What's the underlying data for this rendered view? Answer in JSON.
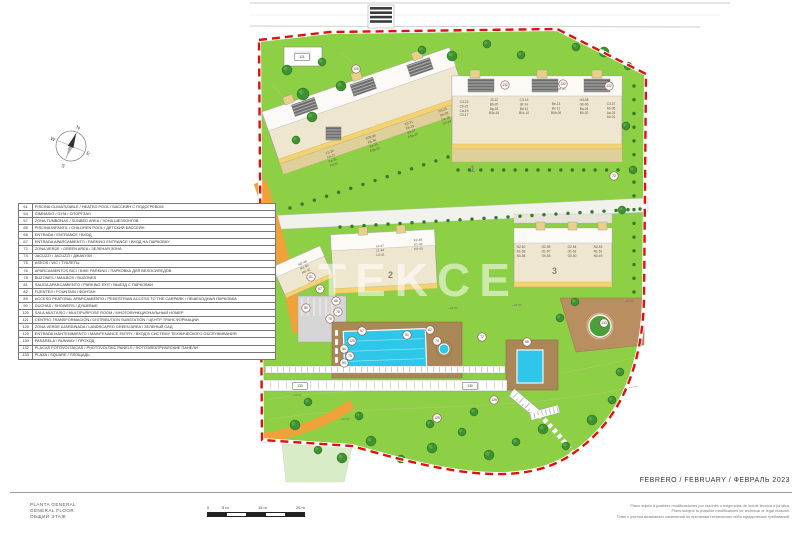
{
  "sheet": {
    "title_block": [
      "PLANTA GENERAL",
      "GENERAL FLOOR",
      "ОБЩИЙ ЭТАЖ"
    ],
    "date": "FEBRERO / FEBRUARY / ФЕВРАЛЬ 2023",
    "disclaimer": [
      "Plano sujeto a posibles modificaciones por razones o exigencias de índole técnica o jurídica.",
      "Plans subject to possible modifications for technical or legal reasons.",
      "План с учетом возможных изменений по причинам технических либо юридических требований."
    ],
    "scale": {
      "labels": [
        "0",
        "5 m",
        "15 m",
        "25 m"
      ]
    },
    "compass": {
      "n": "N",
      "e": "E",
      "s": "S",
      "w": "W"
    }
  },
  "legend": {
    "rows": [
      {
        "num": "51",
        "label": "PISCINA CLIMATIZABLE / HEATED POOL / БАССЕЙН С ПОДОГРЕВОМ"
      },
      {
        "num": "54",
        "label": "GIMNASIO / GYM / СПОРТЗАЛ"
      },
      {
        "num": "57",
        "label": "ZONA TUMBONAS / SUNBED AREA / ЗОНА ШЕЗЛОНГОВ"
      },
      {
        "num": "65",
        "label": "PISCINA INFANTIL / CHILDREN POOL / ДЕТСКИЙ БАССЕЙН"
      },
      {
        "num": "66",
        "label": "ENTRADA / ENTRANCE / ВХОД"
      },
      {
        "num": "67",
        "label": "ENTRADA APARCAMIENTO / PARKING ENTRANCE / ВХОД НА ПАРКОВКУ"
      },
      {
        "num": "72",
        "label": "ZONA VERDE / GREEN AREA / ЗЕЛЕНАЯ ЗОНА"
      },
      {
        "num": "74",
        "label": "JACUZZI / JACUZZI / ДЖАКУЗИ"
      },
      {
        "num": "75",
        "label": "ASEOS / WC / ТУАЛЕТЫ"
      },
      {
        "num": "76",
        "label": "APARCAMIENTOS BICI / BIKE PARKING / ПАРКОВКА ДЛЯ ВЕЛОСИПЕДОВ"
      },
      {
        "num": "78",
        "label": "BUZONES / MAILBOX / BUZONES"
      },
      {
        "num": "81",
        "label": "SALIDA APARCAMIENTO / PARKING EXIT / ВЫЕЗД С ПАРКОВКИ"
      },
      {
        "num": "82",
        "label": "FUENTES / FOUNTAIN / ФОНТАН"
      },
      {
        "num": "89",
        "label": "ACCESO PEATONAL APARCAMIENTO / PEDESTRIAN ACCESS TO THE CARPARK / ПЕШЕХОДНАЯ ПАРКОВКА"
      },
      {
        "num": "90",
        "label": "DUCHAS / SHOWERS / ДУШЕВЫЕ"
      },
      {
        "num": "120",
        "label": "SALA MULTIUSO / MULTIPURPOSE ROOM / МНОГОФУНКЦИОНАЛЬНЫЙ НОМЕР"
      },
      {
        "num": "121",
        "label": "CENTRO TRANSFORMACIÓN / DISTRIBUTION SUBSTATION / ЦЕНТР ТРАНСФОРМАЦИИ"
      },
      {
        "num": "125",
        "label": "ZONA VERDE AJARDINADA / LANDSCAPED GREEN AREA / ЗЕЛЕНЫЙ САД"
      },
      {
        "num": "129",
        "label": "ENTRADA MANTENIMIENTO / MAINTENANCE ENTRY / ВХОД В СИСТЕМУ ТЕХНИЧЕСКОГО ОБСЛУЖИВАНИЯ"
      },
      {
        "num": "130",
        "label": "PASARELA / RUNWAY / ПРОХОД"
      },
      {
        "num": "132",
        "label": "PLACAS FOTOVOLTAICAS / PHOTOVOLTAIC PANELS / ФОТОЭЛЕКТРИЧЕСКИЕ ПАНЕЛИ"
      },
      {
        "num": "133",
        "label": "PLAZA / SQUARE / ПЛОЩАДЬ"
      }
    ]
  },
  "plan": {
    "watermark": "TEKCE",
    "colors": {
      "green": "#8dcf45",
      "light_green": "#d9ecc8",
      "boundary_red": "#dd1111",
      "pool_blue": "#2ec7e9",
      "deck_brown": "#aa8757",
      "building_cream": "#efe6cf",
      "road_orange": "#f0a23a",
      "accent_yellow": "#f2d271"
    },
    "building_numbers": [
      {
        "text": "1",
        "x": 470,
        "y": 172
      },
      {
        "text": "2",
        "x": 388,
        "y": 278
      },
      {
        "text": "3",
        "x": 552,
        "y": 274
      }
    ],
    "unit_groups": [
      {
        "x": 464,
        "y": 103,
        "rot": 0,
        "lines": [
          "C3-23",
          "Cb-21",
          "Ca-19",
          "C0-17"
        ]
      },
      {
        "x": 494,
        "y": 101,
        "rot": 0,
        "lines": [
          "J3-22",
          "Bb-20",
          "Bg-18",
          "B0a-16"
        ]
      },
      {
        "x": 524,
        "y": 101,
        "rot": 0,
        "lines": [
          "C3-15",
          "Bf-14",
          "Bd-12",
          "B0c-10"
        ]
      },
      {
        "x": 556,
        "y": 105,
        "rot": 0,
        "lines": [
          "Be-13",
          "Bc-11",
          "B0b-09"
        ]
      },
      {
        "x": 584,
        "y": 101,
        "rot": 0,
        "lines": [
          "H3-08",
          "Gb-06",
          "Ba-04",
          "B0-02"
        ]
      },
      {
        "x": 611,
        "y": 105,
        "rot": 0,
        "lines": [
          "C3-07",
          "Ab-05",
          "Aa-03",
          "A0-01"
        ]
      },
      {
        "x": 330,
        "y": 153,
        "rot": -19,
        "lines": [
          "F3-39",
          "Fb-37",
          "Fa-35",
          "F0-33"
        ]
      },
      {
        "x": 371,
        "y": 138,
        "rot": -19,
        "lines": [
          "E0b-38",
          "Eb-36",
          "Ea-34",
          "E0b-32"
        ]
      },
      {
        "x": 409,
        "y": 124,
        "rot": -19,
        "lines": [
          "E3-31",
          "Eb-29",
          "Ea-27",
          "E0a-25"
        ]
      },
      {
        "x": 443,
        "y": 111,
        "rot": -19,
        "lines": [
          "D3-30",
          "Db-28",
          "Da-26",
          "D0-24"
        ]
      },
      {
        "x": 380,
        "y": 247,
        "rot": -3,
        "lines": [
          "L2-47",
          "L1-44",
          "L0-41"
        ]
      },
      {
        "x": 418,
        "y": 241,
        "rot": -3,
        "lines": [
          "K2-46",
          "K1-43",
          "K0-40"
        ]
      },
      {
        "x": 303,
        "y": 264,
        "rot": -24,
        "lines": [
          "M2-48",
          "M1-45",
          "M0-42"
        ]
      },
      {
        "x": 521,
        "y": 248,
        "rot": 0,
        "lines": [
          "N2-60",
          "N1-58",
          "N0-56"
        ]
      },
      {
        "x": 546,
        "y": 248,
        "rot": 0,
        "lines": [
          "O2-59",
          "O1-57",
          "O0-55"
        ]
      },
      {
        "x": 572,
        "y": 248,
        "rot": 0,
        "lines": [
          "O2-54",
          "O1-52",
          "O0-50"
        ]
      },
      {
        "x": 598,
        "y": 248,
        "rot": 0,
        "lines": [
          "N2-53",
          "N1-51",
          "N0-49"
        ]
      }
    ],
    "markers": [
      {
        "ref": "121",
        "x": 302,
        "y": 57,
        "box": true
      },
      {
        "ref": "125",
        "x": 356,
        "y": 69
      },
      {
        "ref": "132",
        "x": 505,
        "y": 85
      },
      {
        "ref": "132",
        "x": 563,
        "y": 84
      },
      {
        "ref": "132",
        "x": 609,
        "y": 86
      },
      {
        "ref": "72",
        "x": 614,
        "y": 176
      },
      {
        "ref": "81",
        "x": 311,
        "y": 277
      },
      {
        "ref": "67",
        "x": 320,
        "y": 289
      },
      {
        "ref": "66",
        "x": 336,
        "y": 301
      },
      {
        "ref": "89",
        "x": 306,
        "y": 308
      },
      {
        "ref": "78",
        "x": 338,
        "y": 312
      },
      {
        "ref": "76",
        "x": 330,
        "y": 319
      },
      {
        "ref": "120",
        "x": 352,
        "y": 341
      },
      {
        "ref": "54",
        "x": 344,
        "y": 349
      },
      {
        "ref": "75",
        "x": 350,
        "y": 356
      },
      {
        "ref": "90",
        "x": 344,
        "y": 363
      },
      {
        "ref": "57",
        "x": 362,
        "y": 331
      },
      {
        "ref": "51",
        "x": 407,
        "y": 335
      },
      {
        "ref": "82",
        "x": 430,
        "y": 330
      },
      {
        "ref": "74",
        "x": 437,
        "y": 341
      },
      {
        "ref": "72",
        "x": 482,
        "y": 337
      },
      {
        "ref": "65",
        "x": 527,
        "y": 342
      },
      {
        "ref": "133",
        "x": 604,
        "y": 323
      },
      {
        "ref": "130",
        "x": 300,
        "y": 386,
        "box": true
      },
      {
        "ref": "130",
        "x": 470,
        "y": 386,
        "box": true
      },
      {
        "ref": "129",
        "x": 494,
        "y": 400
      },
      {
        "ref": "125",
        "x": 437,
        "y": 418
      }
    ],
    "elevations": [
      {
        "text": "+48.30",
        "x": 556,
        "y": 90
      },
      {
        "text": "+40.50",
        "x": 448,
        "y": 309
      },
      {
        "text": "+40.50",
        "x": 512,
        "y": 306
      },
      {
        "text": "+46.50",
        "x": 624,
        "y": 302
      },
      {
        "text": "+44.50",
        "x": 292,
        "y": 396
      },
      {
        "text": "+40.50",
        "x": 340,
        "y": 420
      }
    ]
  }
}
